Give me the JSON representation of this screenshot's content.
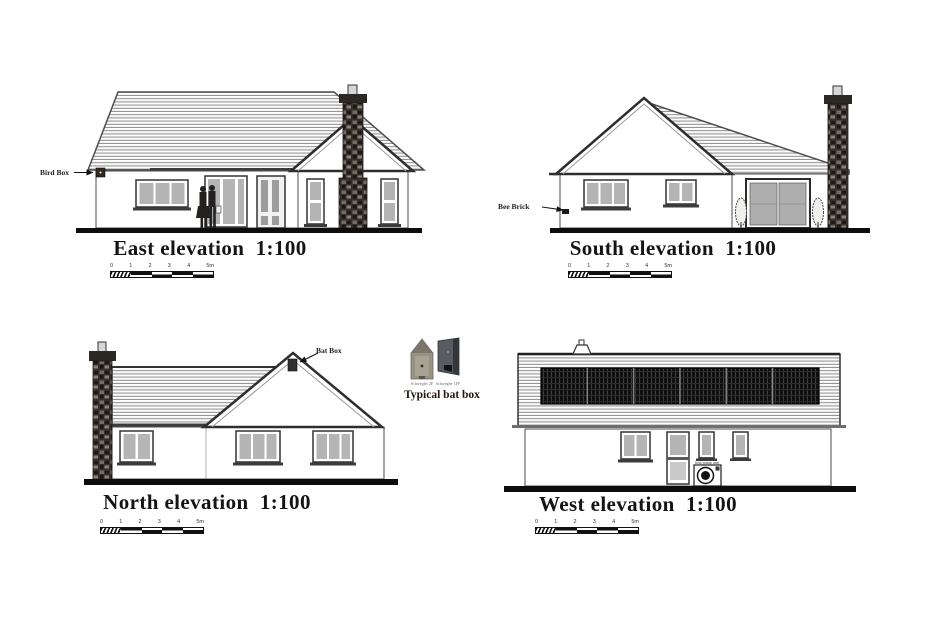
{
  "drawing": {
    "elevations": {
      "east": {
        "title": "East elevation  1:100"
      },
      "south": {
        "title": "South elevation  1:100"
      },
      "north": {
        "title": "North elevation  1:100"
      },
      "west": {
        "title": "West elevation  1:100"
      }
    },
    "annotations": {
      "bird_box": "Bird Box",
      "bee_brick": "Bee Brick",
      "bat_box": "Bat Box",
      "typical_bat_box": "Typical bat box",
      "bat_box_caption_left": "Schwegler 2F",
      "bat_box_caption_right": "Schwegler 1FF",
      "heat_pump_label_1": "air source",
      "heat_pump_label_2": "heat pump unit"
    },
    "scalebar": {
      "ticks": [
        "0",
        "1",
        "2",
        "3",
        "4",
        "5m"
      ]
    },
    "colors": {
      "line": "#1a1a1a",
      "roof_hatch": "#8d8d8d",
      "glass": "#b4b4b4",
      "solar_panel": "#101010",
      "stone": "#35302b"
    }
  }
}
